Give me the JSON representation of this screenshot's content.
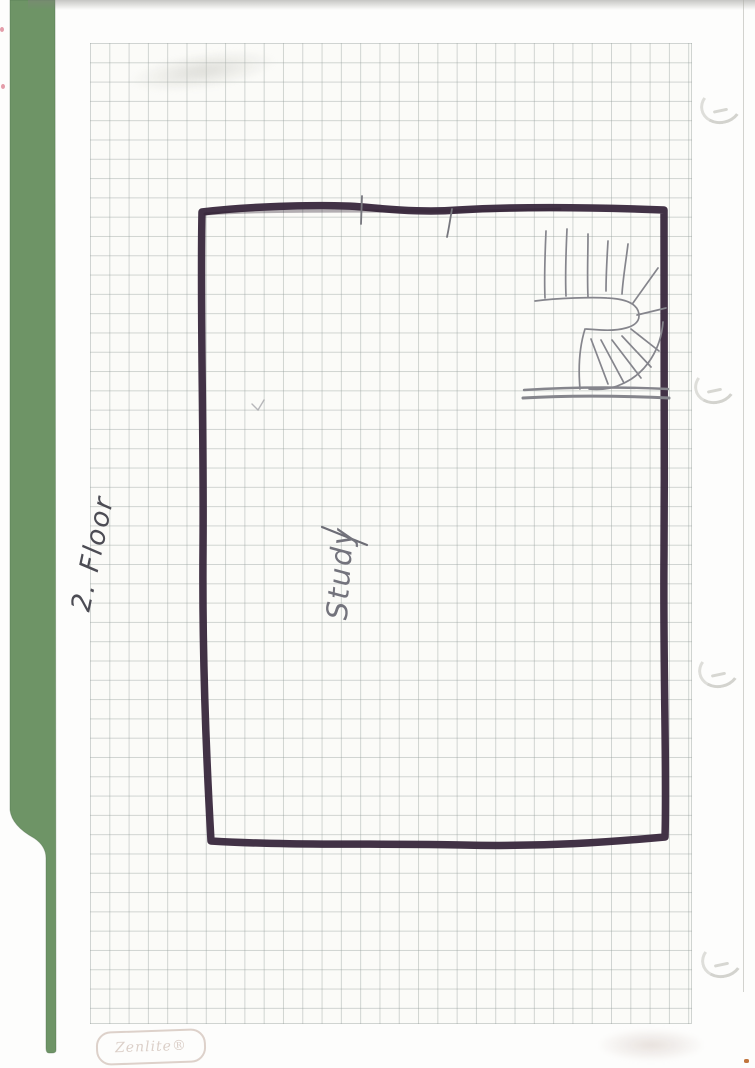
{
  "document": {
    "kind": "Scanned hand-drawn floor plan on squared paper in a green folder",
    "floor_label": "2. Floor",
    "room_label": "Study",
    "paper_brand": "Zenlite®",
    "features": {
      "room_outline": "large rectangle drawn in dark marker",
      "staircase": "pencil switchback staircase with winder treads, top-right corner of the room",
      "wall_ticks": "two small pencil tick marks crossing the top wall",
      "binder_tab": "green folder strip along left edge tapering to a narrow stem",
      "punch_hole_shadows": 4
    },
    "colors": {
      "folder_green": "#6e9466",
      "marker_ink": "#3a2a3e",
      "pencil": "#85858c",
      "grid_line": "#c5c9c7",
      "paper": "#fbfbf8"
    }
  }
}
